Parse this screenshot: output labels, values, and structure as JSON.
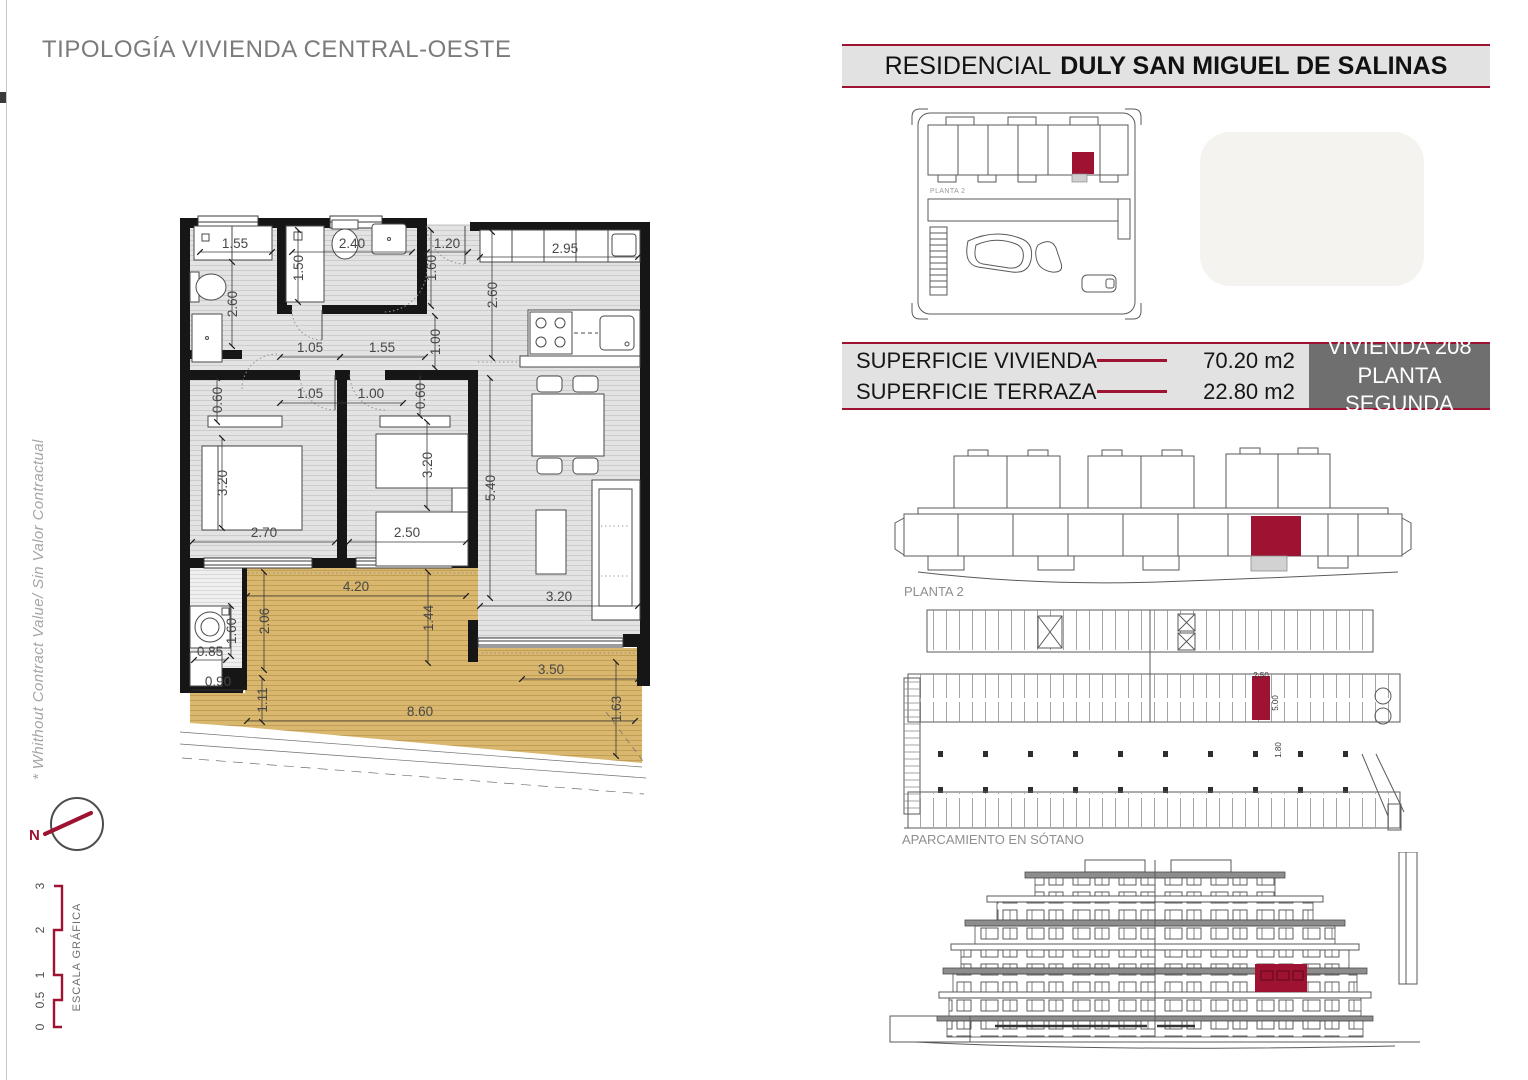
{
  "page_title": "TIPOLOGÍA VIVIENDA CENTRAL-OESTE",
  "header": {
    "prefix": "RESIDENCIAL",
    "name": "DULY SAN MIGUEL DE SALINAS"
  },
  "info": {
    "rows": [
      {
        "label": "SUPERFICIE VIVIENDA",
        "value": "70.20 m2"
      },
      {
        "label": "SUPERFICIE TERRAZA",
        "value": "22.80 m2"
      }
    ],
    "unit": {
      "line1": "VIVIENDA 208",
      "line2": "PLANTA SEGUNDA"
    }
  },
  "side_note": "* Whithout Contract Value/ Sin Valor Contractual",
  "compass": {
    "label": "N"
  },
  "scale_bar": {
    "title": "ESCALA GRÁFICA",
    "ticks": [
      "0",
      "0.5",
      "1",
      "2",
      "3"
    ]
  },
  "key_plan": {
    "label": "PLANTA 2"
  },
  "floor_overview": {
    "label": "PLANTA 2"
  },
  "parking": {
    "label": "APARCAMIENTO EN SÓTANO",
    "dim_labels": [
      {
        "t": "2.50",
        "x": 373,
        "y": 74
      },
      {
        "t": "5.00",
        "x": 390,
        "y": 99,
        "r": -90
      },
      {
        "t": "1.80",
        "x": 393,
        "y": 146,
        "r": -90
      }
    ]
  },
  "floor_plan": {
    "dim_labels": [
      {
        "t": "1.55",
        "x": 55,
        "y": 38
      },
      {
        "t": "2.40",
        "x": 172,
        "y": 38
      },
      {
        "t": "1.20",
        "x": 267,
        "y": 38
      },
      {
        "t": "2.95",
        "x": 385,
        "y": 43
      },
      {
        "t": "2.60",
        "x": 57,
        "y": 94,
        "r": -90
      },
      {
        "t": "1.50",
        "x": 123,
        "y": 58,
        "r": -90
      },
      {
        "t": "1.60",
        "x": 256,
        "y": 58,
        "r": -90
      },
      {
        "t": "2.60",
        "x": 317,
        "y": 85,
        "r": -90
      },
      {
        "t": "1.00",
        "x": 260,
        "y": 132,
        "r": -90
      },
      {
        "t": "1.05",
        "x": 130,
        "y": 142
      },
      {
        "t": "1.55",
        "x": 202,
        "y": 142
      },
      {
        "t": "0.60",
        "x": 42,
        "y": 190,
        "r": -90
      },
      {
        "t": "1.05",
        "x": 130,
        "y": 188
      },
      {
        "t": "1.00",
        "x": 191,
        "y": 188
      },
      {
        "t": "0.60",
        "x": 245,
        "y": 186,
        "r": -90
      },
      {
        "t": "3.20",
        "x": 47,
        "y": 273,
        "r": -90
      },
      {
        "t": "2.70",
        "x": 84,
        "y": 327
      },
      {
        "t": "3.20",
        "x": 252,
        "y": 255,
        "r": -90
      },
      {
        "t": "2.50",
        "x": 227,
        "y": 327
      },
      {
        "t": "5.40",
        "x": 315,
        "y": 278,
        "r": -90
      },
      {
        "t": "3.20",
        "x": 379,
        "y": 391
      },
      {
        "t": "4.20",
        "x": 176,
        "y": 381
      },
      {
        "t": "2.06",
        "x": 89,
        "y": 411,
        "r": -90
      },
      {
        "t": "1.44",
        "x": 253,
        "y": 408,
        "r": -90
      },
      {
        "t": "1.60",
        "x": 56,
        "y": 421,
        "r": -90
      },
      {
        "t": "0.85",
        "x": 30,
        "y": 446
      },
      {
        "t": "0.90",
        "x": 38,
        "y": 476
      },
      {
        "t": "1.11",
        "x": 87,
        "y": 490,
        "r": -90
      },
      {
        "t": "8.60",
        "x": 240,
        "y": 506
      },
      {
        "t": "3.50",
        "x": 371,
        "y": 464
      },
      {
        "t": "1.63",
        "x": 441,
        "y": 499,
        "r": -90
      }
    ]
  },
  "colors": {
    "accent": "#9E1232",
    "panel_gray": "#E2E2E2",
    "dark_gray": "#6F6F6F",
    "terrace": "#D9B76E"
  }
}
